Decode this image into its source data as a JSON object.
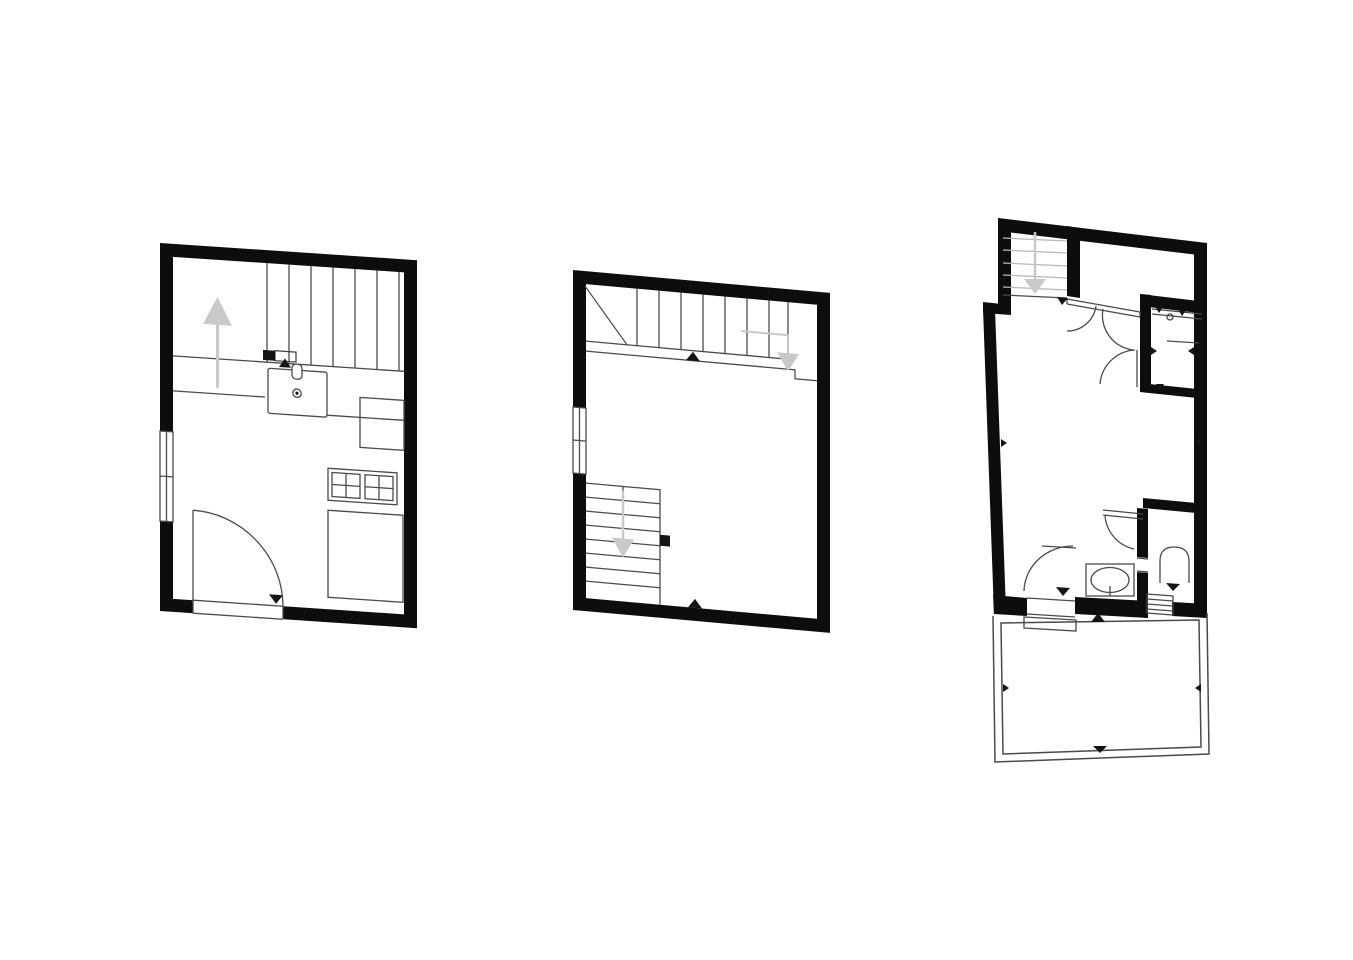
{
  "page": {
    "background": "#ffffff"
  },
  "colors": {
    "background": "#ffffff",
    "wall": "#0d0d0d",
    "line": "#4a4a4a",
    "light_line": "#b8b8b8",
    "arrow": "#c9c9c9",
    "marker": "#141414",
    "paper": "#ffffff"
  },
  "plans": [
    {
      "id": "plan-1",
      "position": "left",
      "features": [
        "north-arrow",
        "staircase-up",
        "landing-line",
        "kitchen-sink",
        "faucet",
        "drain",
        "stove-4-burner",
        "kitchen-counter",
        "base-cabinet",
        "entry-door-swing",
        "window-double-pane",
        "threshold-markers"
      ]
    },
    {
      "id": "plan-2",
      "position": "middle",
      "features": [
        "upper-staircase",
        "stair-break-line",
        "down-arrow",
        "lower-staircase",
        "down-arrow-2",
        "wall-stub",
        "window-double-pane",
        "threshold-markers"
      ]
    },
    {
      "id": "plan-3",
      "position": "right",
      "features": [
        "staircase-down",
        "down-arrow",
        "double-entry-door",
        "interior-door-swings",
        "storage-room",
        "shelf-lines",
        "bathroom-door-swing",
        "bathroom-sink",
        "wc-room",
        "toilet",
        "exterior-steps",
        "door-step",
        "terrace-outline",
        "direction-ticks"
      ]
    }
  ]
}
